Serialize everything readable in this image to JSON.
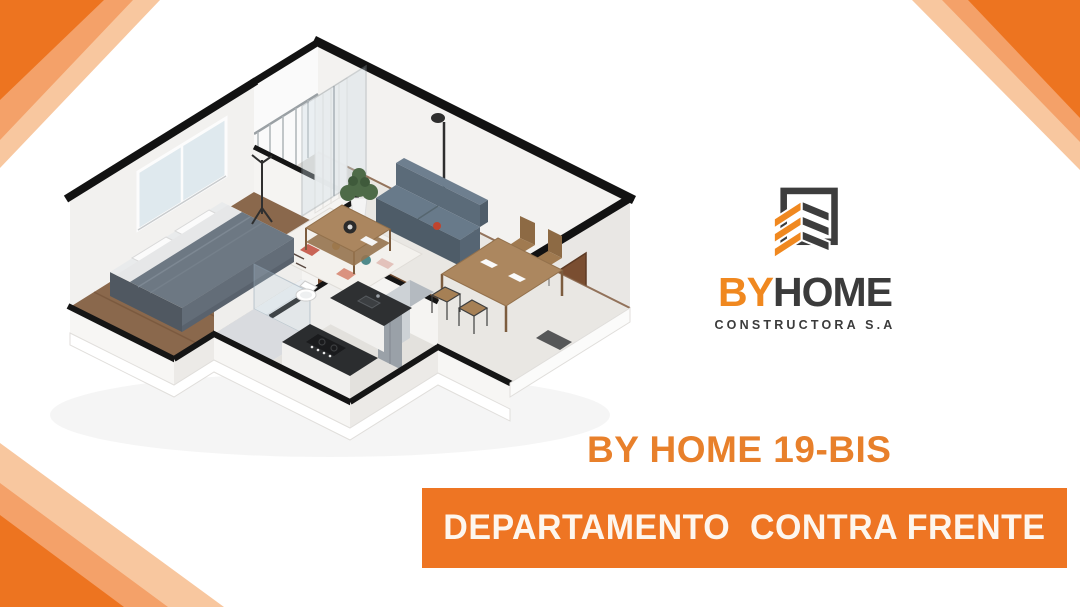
{
  "brand": {
    "name_primary": "BY",
    "name_secondary": "HOME",
    "subtitle": "CONSTRUCTORA S.A"
  },
  "titles": {
    "project": "BY HOME 19-BIS",
    "banner": "DEPARTAMENTO  CONTRA FRENTE"
  },
  "colors": {
    "orange_solid": "#ED7420",
    "orange_medium": "#F4A169",
    "orange_light": "#F8C79F",
    "banner_background": "#EE7523",
    "banner_text": "#FDF6EE",
    "project_title": "#E8802B",
    "logo_orange": "#F0881F",
    "logo_dark": "#3B3B3B"
  }
}
